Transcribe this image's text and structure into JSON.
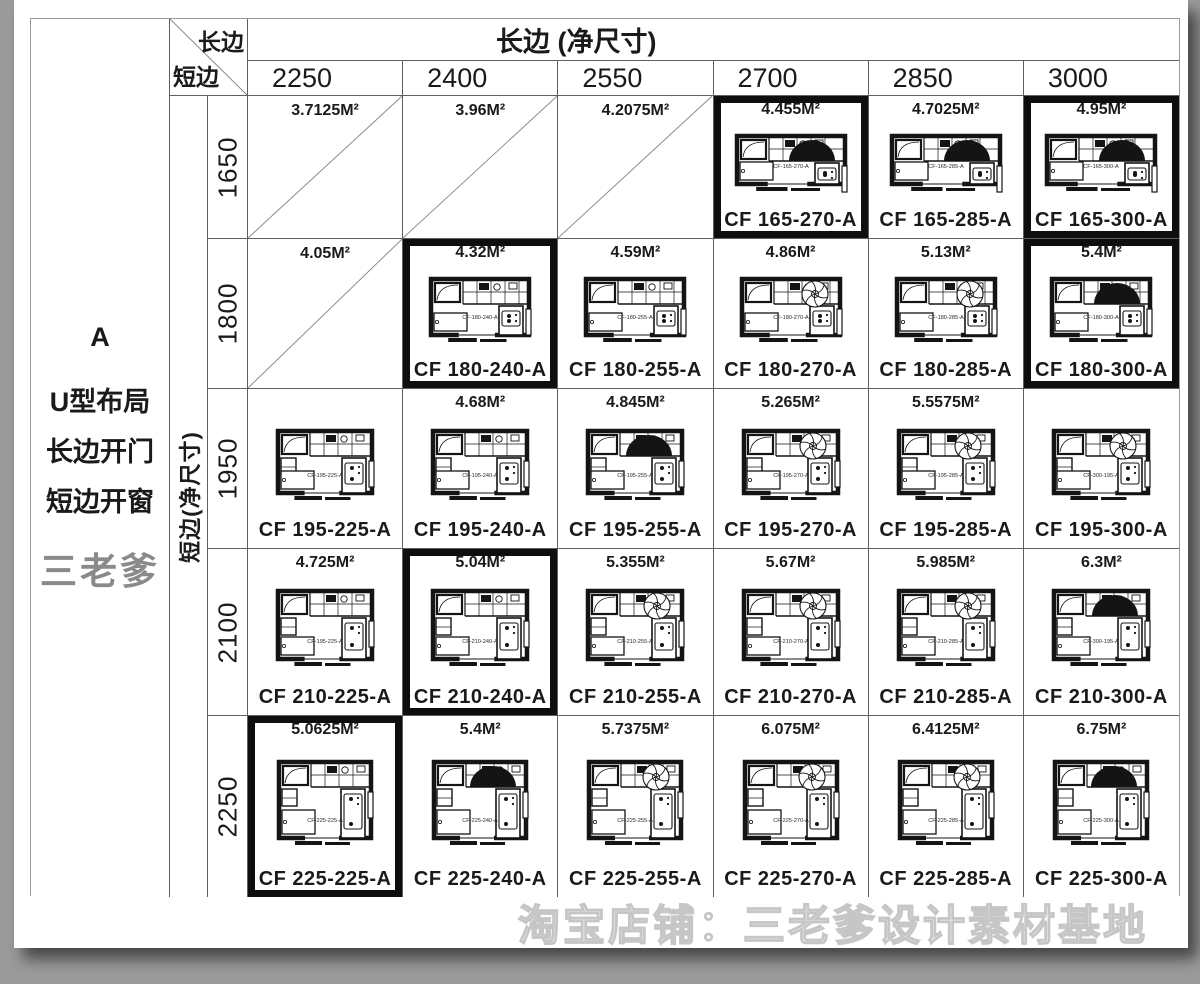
{
  "page": {
    "left_panel": {
      "code": "A",
      "lines": [
        "U型布局",
        "长边开门",
        "短边开窗"
      ],
      "brand": "三老爹"
    },
    "header": {
      "corner_top": "长边",
      "corner_bottom": "短边",
      "long_side_title": "长边 (净尺寸)",
      "short_side_title": "短边(净尺寸)",
      "columns": [
        "2250",
        "2400",
        "2550",
        "2700",
        "2850",
        "3000"
      ]
    },
    "watermark": "淘宝店铺：三老爹设计素材基地",
    "colors": {
      "canvas_bg": "#9b9b9b",
      "page_bg": "#ffffff",
      "grid_line": "#5f5f5f",
      "highlight_border": "#0e0e0e",
      "brand_gray": "#8a8a8a",
      "plan_ink": "#141414"
    }
  },
  "rows": [
    {
      "label": "1650",
      "cells": [
        {
          "type": "slash",
          "area": "3.7125M²"
        },
        {
          "type": "slash",
          "area": "3.96M²"
        },
        {
          "type": "slash",
          "area": "4.2075M²"
        },
        {
          "type": "plan",
          "area": "4.455M²",
          "code": "CF 165-270-A",
          "inner": "CF-165-270-A",
          "glyph": "dome",
          "highlight": true
        },
        {
          "type": "plan",
          "area": "4.7025M²",
          "code": "CF 165-285-A",
          "inner": "CF-165-285-A",
          "glyph": "dome",
          "highlight": false
        },
        {
          "type": "plan",
          "area": "4.95M²",
          "code": "CF 165-300-A",
          "inner": "CF-165-300-A",
          "glyph": "dome",
          "highlight": true
        }
      ]
    },
    {
      "label": "1800",
      "cells": [
        {
          "type": "slash",
          "area": "4.05M²"
        },
        {
          "type": "plan",
          "area": "4.32M²",
          "code": "CF 180-240-A",
          "inner": "CF-180-240-A",
          "glyph": "none",
          "highlight": true
        },
        {
          "type": "plan",
          "area": "4.59M²",
          "code": "CF 180-255-A",
          "inner": "CF-180-255-A",
          "glyph": "none",
          "highlight": false
        },
        {
          "type": "plan",
          "area": "4.86M²",
          "code": "CF 180-270-A",
          "inner": "CF-180-270-A",
          "glyph": "fan",
          "highlight": false
        },
        {
          "type": "plan",
          "area": "5.13M²",
          "code": "CF 180-285-A",
          "inner": "CF-180-285-A",
          "glyph": "fan",
          "highlight": false
        },
        {
          "type": "plan",
          "area": "5.4M²",
          "code": "CF 180-300-A",
          "inner": "CF-180-300-A",
          "glyph": "dome",
          "highlight": true
        }
      ]
    },
    {
      "label": "1950",
      "cells": [
        {
          "type": "plan",
          "area": "",
          "code": "CF 195-225-A",
          "inner": "CF-195-225-A",
          "glyph": "none",
          "highlight": false
        },
        {
          "type": "plan",
          "area": "4.68M²",
          "code": "CF 195-240-A",
          "inner": "CF-195-240-A",
          "glyph": "none",
          "highlight": false
        },
        {
          "type": "plan",
          "area": "4.845M²",
          "code": "CF 195-255-A",
          "inner": "CF-195-255-A",
          "glyph": "dome",
          "highlight": false
        },
        {
          "type": "plan",
          "area": "5.265M²",
          "code": "CF 195-270-A",
          "inner": "CF-195-270-A",
          "glyph": "fan",
          "highlight": false
        },
        {
          "type": "plan",
          "area": "5.5575M²",
          "code": "CF 195-285-A",
          "inner": "CF-195-285-A",
          "glyph": "fan",
          "highlight": false
        },
        {
          "type": "plan",
          "area": "",
          "code": "CF 195-300-A",
          "inner": "CF-300-195-A",
          "glyph": "fan",
          "highlight": false
        }
      ]
    },
    {
      "label": "2100",
      "cells": [
        {
          "type": "plan",
          "area": "4.725M²",
          "code": "CF 210-225-A",
          "inner": "CF-195-225-A",
          "glyph": "none",
          "highlight": false
        },
        {
          "type": "plan",
          "area": "5.04M²",
          "code": "CF 210-240-A",
          "inner": "CF-210-240-A",
          "glyph": "none",
          "highlight": true
        },
        {
          "type": "plan",
          "area": "5.355M²",
          "code": "CF 210-255-A",
          "inner": "CF-210-255-A",
          "glyph": "fan",
          "highlight": false
        },
        {
          "type": "plan",
          "area": "5.67M²",
          "code": "CF 210-270-A",
          "inner": "CF-210-270-A",
          "glyph": "fan",
          "highlight": false
        },
        {
          "type": "plan",
          "area": "5.985M²",
          "code": "CF 210-285-A",
          "inner": "CF-210-285-A",
          "glyph": "fan",
          "highlight": false
        },
        {
          "type": "plan",
          "area": "6.3M²",
          "code": "CF 210-300-A",
          "inner": "CF-300-195-A",
          "glyph": "dome",
          "highlight": false
        }
      ]
    },
    {
      "label": "2250",
      "cells": [
        {
          "type": "plan",
          "area": "5.0625M²",
          "code": "CF 225-225-A",
          "inner": "CF-225-225-A",
          "glyph": "none",
          "highlight": true
        },
        {
          "type": "plan",
          "area": "5.4M²",
          "code": "CF 225-240-A",
          "inner": "CF-225-240-A",
          "glyph": "dome",
          "highlight": false
        },
        {
          "type": "plan",
          "area": "5.7375M²",
          "code": "CF 225-255-A",
          "inner": "CF-225-255-A",
          "glyph": "fan",
          "highlight": false
        },
        {
          "type": "plan",
          "area": "6.075M²",
          "code": "CF 225-270-A",
          "inner": "CF-225-270-A",
          "glyph": "fan",
          "highlight": false
        },
        {
          "type": "plan",
          "area": "6.4125M²",
          "code": "CF 225-285-A",
          "inner": "CF-225-285-A",
          "glyph": "fan",
          "highlight": false
        },
        {
          "type": "plan",
          "area": "6.75M²",
          "code": "CF 225-300-A",
          "inner": "CF-225-300-A",
          "glyph": "dome",
          "highlight": false
        }
      ]
    }
  ],
  "plan_row_sizes": {
    "widths": [
      116,
      106,
      102,
      102,
      100
    ],
    "heights": [
      66,
      74,
      80,
      86,
      94
    ]
  }
}
